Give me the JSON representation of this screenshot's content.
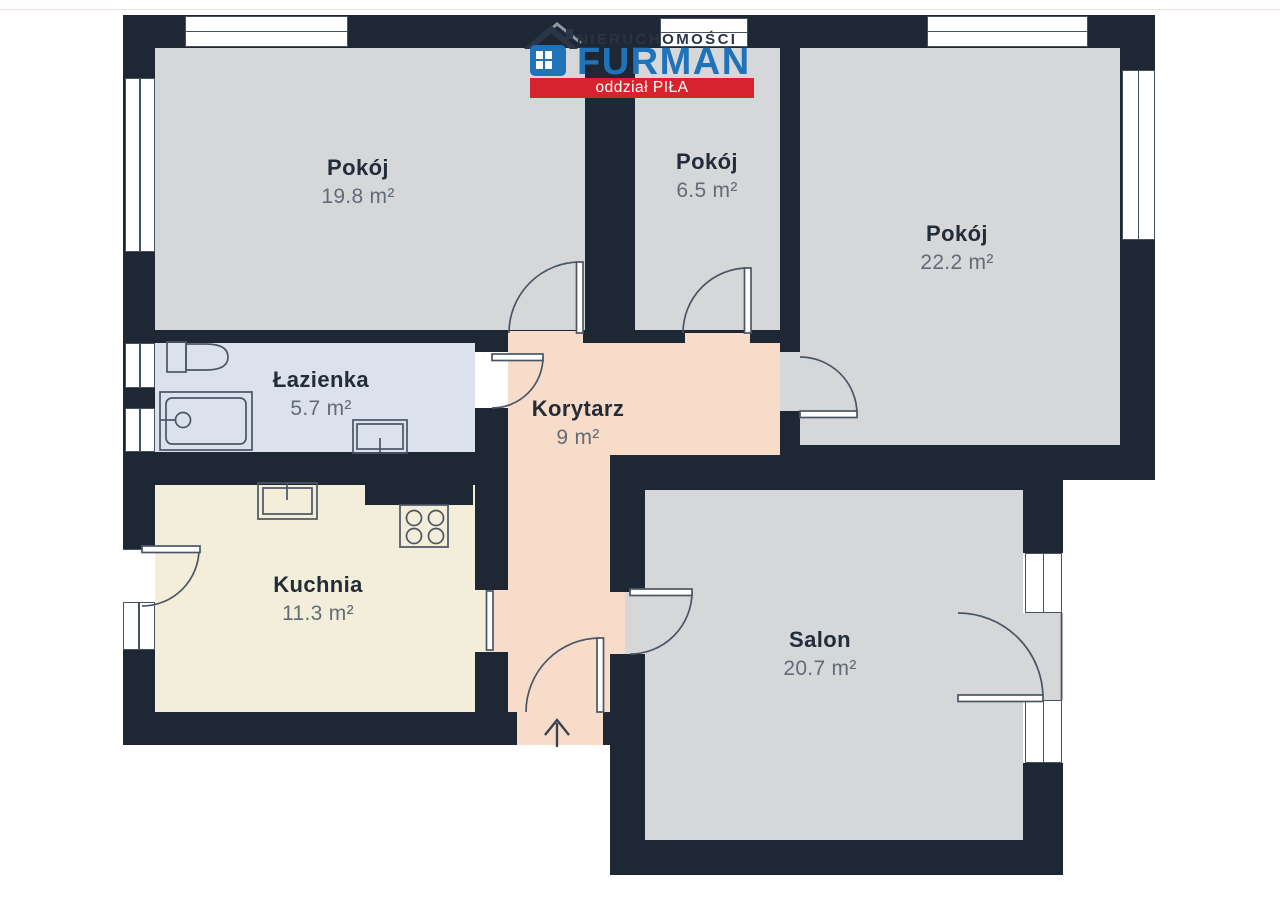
{
  "logo": {
    "line1": "NIERUCHOMOŚCI",
    "line2": "FURMAN",
    "banner": "oddział PIŁA"
  },
  "rooms": [
    {
      "name": "Pokój",
      "area": "19.8 m²"
    },
    {
      "name": "Pokój",
      "area": "6.5 m²"
    },
    {
      "name": "Pokój",
      "area": "22.2 m²"
    },
    {
      "name": "Łazienka",
      "area": "5.7 m²"
    },
    {
      "name": "Korytarz",
      "area": "9 m²"
    },
    {
      "name": "Kuchnia",
      "area": "11.3 m²"
    },
    {
      "name": "Salon",
      "area": "20.7 m²"
    }
  ],
  "icons": [
    "house-icon",
    "toilet-icon",
    "bathtub-icon",
    "shower-icon",
    "bathroom-sink-icon",
    "kitchen-sink-icon",
    "stove-icon",
    "entrance-arrow-icon",
    "door-arc-icon",
    "window-icon"
  ],
  "colors": {
    "wall": "#1d2834",
    "room": "#d6d7d9",
    "bathroom": "#dce1ee",
    "corridor": "#f8dccA",
    "kitchen": "#f3eeda",
    "logo_blue": "#2173b9",
    "logo_red": "#d6232d",
    "logo_dark": "#2a3341"
  }
}
